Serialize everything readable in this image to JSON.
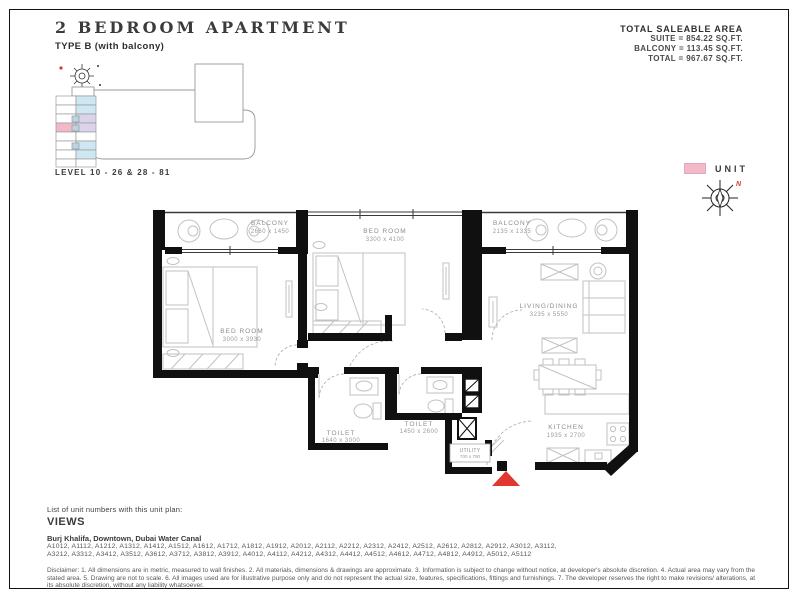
{
  "header": {
    "title": "2 BEDROOM APARTMENT",
    "subtitle": "TYPE B (with balcony)"
  },
  "saleable_area": {
    "heading": "TOTAL SALEABLE AREA",
    "suite": "SUITE = 854.22 SQ.FT.",
    "balcony": "BALCONY = 113.45 SQ.FT.",
    "total": "TOTAL = 967.67 SQ.FT."
  },
  "keyplan": {
    "level_label": "LEVEL 10 - 26 & 28 - 81",
    "highlight_color": "#f4b9c9"
  },
  "legend": {
    "unit_label": "UNIT",
    "unit_color": "#f4b9c9",
    "north_label": "N"
  },
  "rooms": {
    "balcony1": {
      "name": "BALCONY",
      "dims": "2660 x 1450"
    },
    "bedroom2": {
      "name": "BED ROOM",
      "dims": "3300 x 4100"
    },
    "balcony2": {
      "name": "BALCONY",
      "dims": "2135 x 1335"
    },
    "bedroom1": {
      "name": "BED ROOM",
      "dims": "3000 x 3930"
    },
    "living": {
      "name": "LIVING/DINING",
      "dims": "3235 x 5550"
    },
    "toilet1": {
      "name": "TOILET",
      "dims": "1640 x 3000"
    },
    "toilet2": {
      "name": "TOILET",
      "dims": "1450 x 2600"
    },
    "kitchen": {
      "name": "KITCHEN",
      "dims": "1935 x 2700"
    },
    "utility": {
      "name": "UTILITY",
      "dims": "700 x 790"
    }
  },
  "footer": {
    "list_label": "List of unit numbers with this unit plan:",
    "views_heading": "VIEWS",
    "views_text": "Burj Khalifa, Downtown, Dubai Water Canal",
    "unit_numbers_line1": "A1012, A1112, A1212, A1312, A1412, A1512, A1612, A1712, A1812, A1912, A2012, A2112, A2212, A2312, A2412, A2512, A2612, A2812, A2912, A3012, A3112,",
    "unit_numbers_line2": "A3212, A3312, A3412, A3512, A3612, A3712, A3812, A3912, A4012, A4112, A4212, A4312, A4412, A4512, A4612, A4712, A4812, A4912, A5012, A5112",
    "disclaimer": "Disclaimer: 1. All dimensions are in metric, measured to wall finishes. 2. All materials, dimensions & drawings are approximate. 3. Information is subject to change without notice, at developer's absolute discretion. 4. Actual area may vary from the stated area. 5. Drawing are not to scale. 6. All images used are for illustrative purpose only and do not represent the actual size, features, specifications, fittings and furnishings. 7. The developer reserves the right to make revisions/ alterations, at its absolute discretion, without any liability whatsoever."
  }
}
